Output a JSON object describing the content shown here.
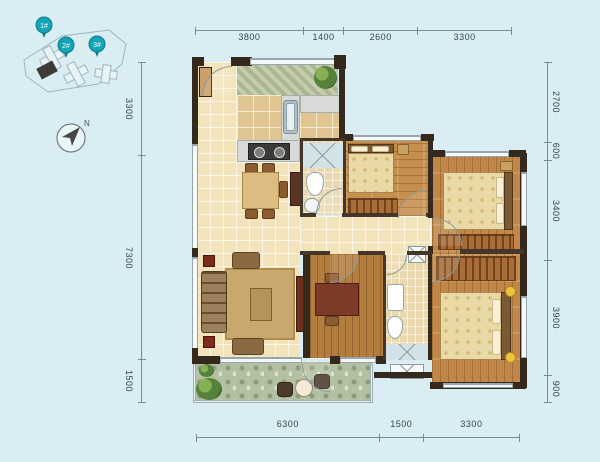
{
  "site_map": {
    "pins": [
      {
        "label": "1#"
      },
      {
        "label": "2#"
      },
      {
        "label": "3#"
      }
    ],
    "pin_color": "#14a4b5"
  },
  "compass": {
    "north": "N"
  },
  "dimensions": {
    "top": [
      "3800",
      "1400",
      "2600",
      "3300"
    ],
    "left": [
      "3300",
      "7300",
      "1500"
    ],
    "right": [
      "2700",
      "600",
      "3400",
      "3900",
      "900"
    ],
    "bottom": [
      "6300",
      "1500",
      "3300"
    ]
  },
  "colors": {
    "background": "#d9edf2",
    "wall": "#35291d",
    "tile_floor": "#f3e3ba",
    "wood_floor": "#c68f4d",
    "balcony_floor": "#b3c0a3",
    "dimension_line": "#7d8c91"
  }
}
